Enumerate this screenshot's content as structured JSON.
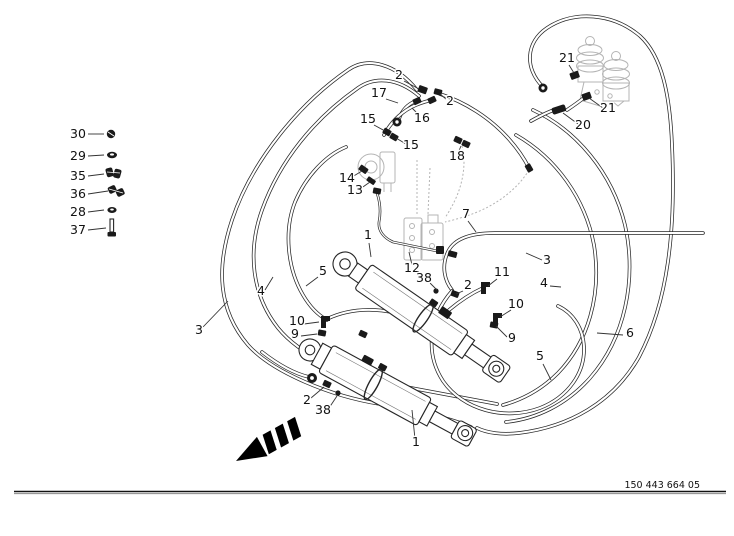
{
  "colors": {
    "ink": "#1a1a1a",
    "faint_component": "#b4b4b4",
    "arrow": "#000000",
    "background": "#ffffff"
  },
  "footer": {
    "drawing_number": "150 443 664 05"
  },
  "legend": {
    "items": [
      {
        "label": "30",
        "icon": "screw-icon"
      },
      {
        "label": "29",
        "icon": "nut-icon"
      },
      {
        "label": "35",
        "icon": "clamp-half-icon"
      },
      {
        "label": "36",
        "icon": "clamp-icon"
      },
      {
        "label": "28",
        "icon": "nut-icon"
      },
      {
        "label": "37",
        "icon": "bolt-icon"
      }
    ]
  },
  "callouts": [
    {
      "text": "2"
    },
    {
      "text": "17"
    },
    {
      "text": "2"
    },
    {
      "text": "15"
    },
    {
      "text": "16"
    },
    {
      "text": "15"
    },
    {
      "text": "18"
    },
    {
      "text": "21"
    },
    {
      "text": "21"
    },
    {
      "text": "20"
    },
    {
      "text": "14"
    },
    {
      "text": "13"
    },
    {
      "text": "1"
    },
    {
      "text": "12"
    },
    {
      "text": "38"
    },
    {
      "text": "2"
    },
    {
      "text": "7"
    },
    {
      "text": "3"
    },
    {
      "text": "4"
    },
    {
      "text": "11"
    },
    {
      "text": "10"
    },
    {
      "text": "9"
    },
    {
      "text": "5"
    },
    {
      "text": "6"
    },
    {
      "text": "3"
    },
    {
      "text": "4"
    },
    {
      "text": "5"
    },
    {
      "text": "10"
    },
    {
      "text": "9"
    },
    {
      "text": "2"
    },
    {
      "text": "38"
    },
    {
      "text": "1"
    }
  ]
}
